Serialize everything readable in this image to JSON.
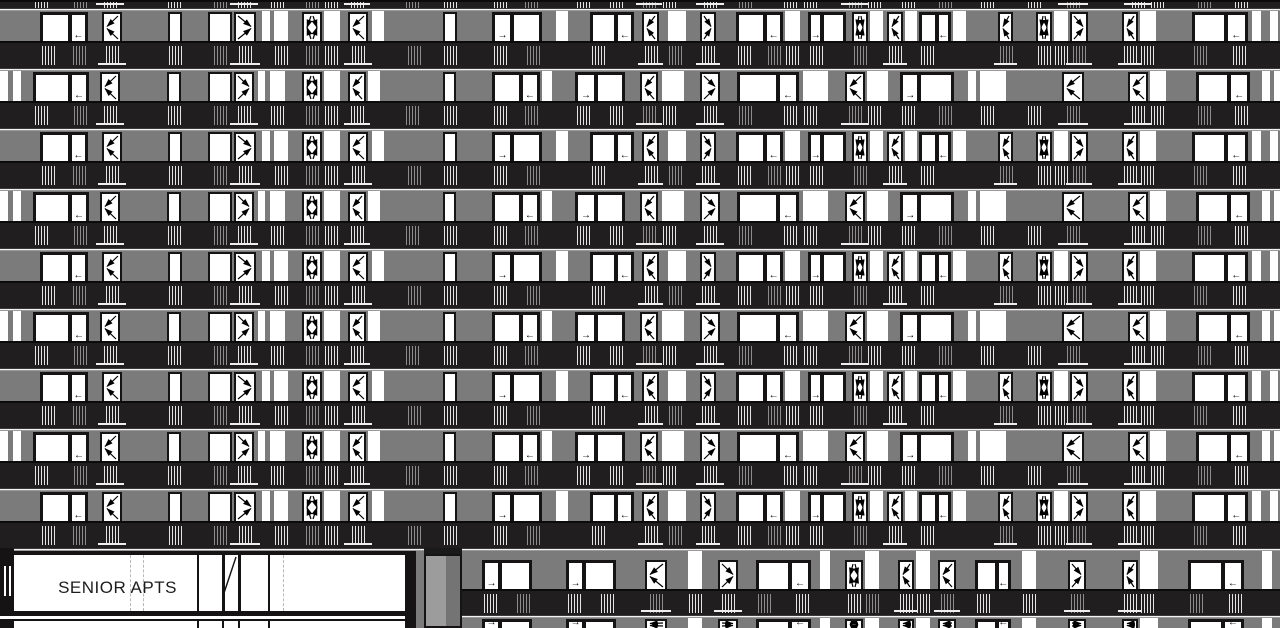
{
  "meta": {
    "drawing_type": "architectural building elevation",
    "description": "multi-storey senior apartment building facade with balconies"
  },
  "ground": {
    "storefront": {
      "label": "SENIOR APTS",
      "mullions": [
        197,
        222,
        238,
        268
      ],
      "dashed_lines": [
        130,
        143,
        283
      ],
      "door_x": 222,
      "door_w": 16
    },
    "pilaster": {
      "x": 424,
      "w": 38
    },
    "right_wing_start": 462
  },
  "colors": {
    "wall": "#7b7b7b",
    "wall_light": "#9c9c9c",
    "railing_band": "#211e1f",
    "frame": "#161314",
    "glass": "#ffffff",
    "slab_line": "#f4f4f4",
    "hatch_light": "#e4e4e4",
    "hatch_gray": "#8d8d8d",
    "text": "#1c1c1c"
  },
  "symbols": {
    "arrow_left": "←",
    "arrow_right": "→"
  },
  "layout": {
    "width": 1280,
    "height": 628,
    "top_band_h": 8,
    "slab_h": 3,
    "wall_h": 30,
    "band_h": 27,
    "floor_count": 9,
    "floor_patterns": [
      "A",
      "B",
      "A",
      "B",
      "A",
      "B",
      "A",
      "B",
      "A"
    ],
    "top_partial_pattern": "B",
    "ground_y": 548,
    "ground_wall_h": 38,
    "ground_band_h": 26
  },
  "patterns": {
    "A": [
      {
        "t": "w",
        "x": 40,
        "w": 48,
        "a": "l",
        "p": "r",
        "s": 0.62
      },
      {
        "t": "d",
        "x": 102,
        "w": 20,
        "o": "l"
      },
      {
        "t": "s",
        "x": 168,
        "w": 14
      },
      {
        "t": "s",
        "x": 208,
        "w": 24
      },
      {
        "t": "d",
        "x": 234,
        "w": 22,
        "o": "r"
      },
      {
        "t": "p",
        "x": 262,
        "w": 8
      },
      {
        "t": "p",
        "x": 274,
        "w": 14
      },
      {
        "t": "d",
        "x": 302,
        "w": 20,
        "o": "x"
      },
      {
        "t": "p",
        "x": 324,
        "w": 16
      },
      {
        "t": "d",
        "x": 348,
        "w": 20,
        "o": "l"
      },
      {
        "t": "p",
        "x": 372,
        "w": 12
      },
      {
        "t": "s",
        "x": 443,
        "w": 14
      },
      {
        "t": "w",
        "x": 492,
        "w": 50,
        "a": "r",
        "p": "l",
        "s": 0.4
      },
      {
        "t": "p",
        "x": 556,
        "w": 12
      },
      {
        "t": "w",
        "x": 590,
        "w": 44,
        "a": "l",
        "p": "r",
        "s": 0.6
      },
      {
        "t": "d",
        "x": 642,
        "w": 17,
        "o": "l"
      },
      {
        "t": "p",
        "x": 668,
        "w": 18
      },
      {
        "t": "d",
        "x": 700,
        "w": 16,
        "o": "r"
      },
      {
        "t": "w",
        "x": 736,
        "w": 47,
        "a": "l",
        "p": "r",
        "s": 0.62
      },
      {
        "t": "p",
        "x": 785,
        "w": 15
      },
      {
        "t": "w",
        "x": 808,
        "w": 38,
        "a": "r",
        "p": "l",
        "s": 0.38
      },
      {
        "t": "d",
        "x": 852,
        "w": 16,
        "o": "x"
      },
      {
        "t": "p",
        "x": 870,
        "w": 13
      },
      {
        "t": "d",
        "x": 887,
        "w": 16,
        "o": "l"
      },
      {
        "t": "p",
        "x": 905,
        "w": 12
      },
      {
        "t": "w",
        "x": 919,
        "w": 32,
        "a": "l",
        "p": "r",
        "s": 0.55
      },
      {
        "t": "p",
        "x": 953,
        "w": 13
      },
      {
        "t": "d",
        "x": 998,
        "w": 15,
        "o": "l"
      },
      {
        "t": "d",
        "x": 1036,
        "w": 16,
        "o": "x"
      },
      {
        "t": "p",
        "x": 1054,
        "w": 14
      },
      {
        "t": "d",
        "x": 1070,
        "w": 18,
        "o": "r"
      },
      {
        "t": "d",
        "x": 1122,
        "w": 16,
        "o": "l"
      },
      {
        "t": "p",
        "x": 1140,
        "w": 16
      },
      {
        "t": "w",
        "x": 1192,
        "w": 56,
        "a": "l",
        "p": "r",
        "s": 0.6
      },
      {
        "t": "p",
        "x": 1252,
        "w": 9
      },
      {
        "t": "p",
        "x": 1270,
        "w": 8
      }
    ],
    "B": [
      {
        "t": "p",
        "x": 0,
        "w": 8
      },
      {
        "t": "p",
        "x": 13,
        "w": 8
      },
      {
        "t": "w",
        "x": 33,
        "w": 56,
        "a": "l",
        "p": "r",
        "s": 0.66
      },
      {
        "t": "d",
        "x": 100,
        "w": 20,
        "o": "l"
      },
      {
        "t": "s",
        "x": 167,
        "w": 14
      },
      {
        "t": "s",
        "x": 208,
        "w": 24
      },
      {
        "t": "d",
        "x": 234,
        "w": 20,
        "o": "r"
      },
      {
        "t": "p",
        "x": 258,
        "w": 7
      },
      {
        "t": "p",
        "x": 270,
        "w": 15
      },
      {
        "t": "d",
        "x": 302,
        "w": 20,
        "o": "x"
      },
      {
        "t": "p",
        "x": 324,
        "w": 16
      },
      {
        "t": "d",
        "x": 348,
        "w": 18,
        "o": "l"
      },
      {
        "t": "p",
        "x": 368,
        "w": 12
      },
      {
        "t": "s",
        "x": 443,
        "w": 13
      },
      {
        "t": "w",
        "x": 492,
        "w": 48,
        "a": "l",
        "p": "r",
        "s": 0.6
      },
      {
        "t": "p",
        "x": 542,
        "w": 10
      },
      {
        "t": "w",
        "x": 575,
        "w": 50,
        "a": "r",
        "p": "l",
        "s": 0.42
      },
      {
        "t": "d",
        "x": 640,
        "w": 18,
        "o": "l"
      },
      {
        "t": "p",
        "x": 662,
        "w": 22
      },
      {
        "t": "d",
        "x": 700,
        "w": 20,
        "o": "r"
      },
      {
        "t": "w",
        "x": 737,
        "w": 62,
        "a": "l",
        "p": "r",
        "s": 0.66
      },
      {
        "t": "p",
        "x": 803,
        "w": 25
      },
      {
        "t": "d",
        "x": 845,
        "w": 20,
        "o": "l"
      },
      {
        "t": "p",
        "x": 867,
        "w": 21
      },
      {
        "t": "w",
        "x": 900,
        "w": 54,
        "a": "r",
        "p": "l",
        "s": 0.36
      },
      {
        "t": "p",
        "x": 968,
        "w": 8
      },
      {
        "t": "p",
        "x": 980,
        "w": 26
      },
      {
        "t": "d",
        "x": 1062,
        "w": 22,
        "o": "l"
      },
      {
        "t": "d",
        "x": 1128,
        "w": 20,
        "o": "l"
      },
      {
        "t": "p",
        "x": 1150,
        "w": 16
      },
      {
        "t": "w",
        "x": 1196,
        "w": 54,
        "a": "l",
        "p": "r",
        "s": 0.62
      },
      {
        "t": "p",
        "x": 1262,
        "w": 8
      },
      {
        "t": "p",
        "x": 1274,
        "w": 6
      }
    ],
    "G": [
      {
        "t": "w",
        "x": 482,
        "w": 50,
        "a": "r",
        "p": "l",
        "s": 0.36
      },
      {
        "t": "w",
        "x": 566,
        "w": 50,
        "a": "r",
        "p": "l",
        "s": 0.36
      },
      {
        "t": "d",
        "x": 645,
        "w": 22,
        "o": "l"
      },
      {
        "t": "p",
        "x": 688,
        "w": 14
      },
      {
        "t": "d",
        "x": 718,
        "w": 20,
        "o": "r"
      },
      {
        "t": "w",
        "x": 756,
        "w": 55,
        "a": "l",
        "p": "r",
        "s": 0.62
      },
      {
        "t": "p",
        "x": 820,
        "w": 10
      },
      {
        "t": "d",
        "x": 845,
        "w": 18,
        "o": "x"
      },
      {
        "t": "p",
        "x": 865,
        "w": 14
      },
      {
        "t": "d",
        "x": 898,
        "w": 16,
        "o": "l"
      },
      {
        "t": "p",
        "x": 916,
        "w": 14
      },
      {
        "t": "d",
        "x": 938,
        "w": 18,
        "o": "l"
      },
      {
        "t": "w",
        "x": 975,
        "w": 36,
        "a": "l",
        "p": "r",
        "s": 0.6
      },
      {
        "t": "p",
        "x": 1022,
        "w": 14
      },
      {
        "t": "d",
        "x": 1068,
        "w": 18,
        "o": "r"
      },
      {
        "t": "d",
        "x": 1122,
        "w": 16,
        "o": "l"
      },
      {
        "t": "p",
        "x": 1140,
        "w": 18
      },
      {
        "t": "w",
        "x": 1188,
        "w": 56,
        "a": "l",
        "p": "r",
        "s": 0.62
      },
      {
        "t": "p",
        "x": 1262,
        "w": 10
      }
    ]
  }
}
